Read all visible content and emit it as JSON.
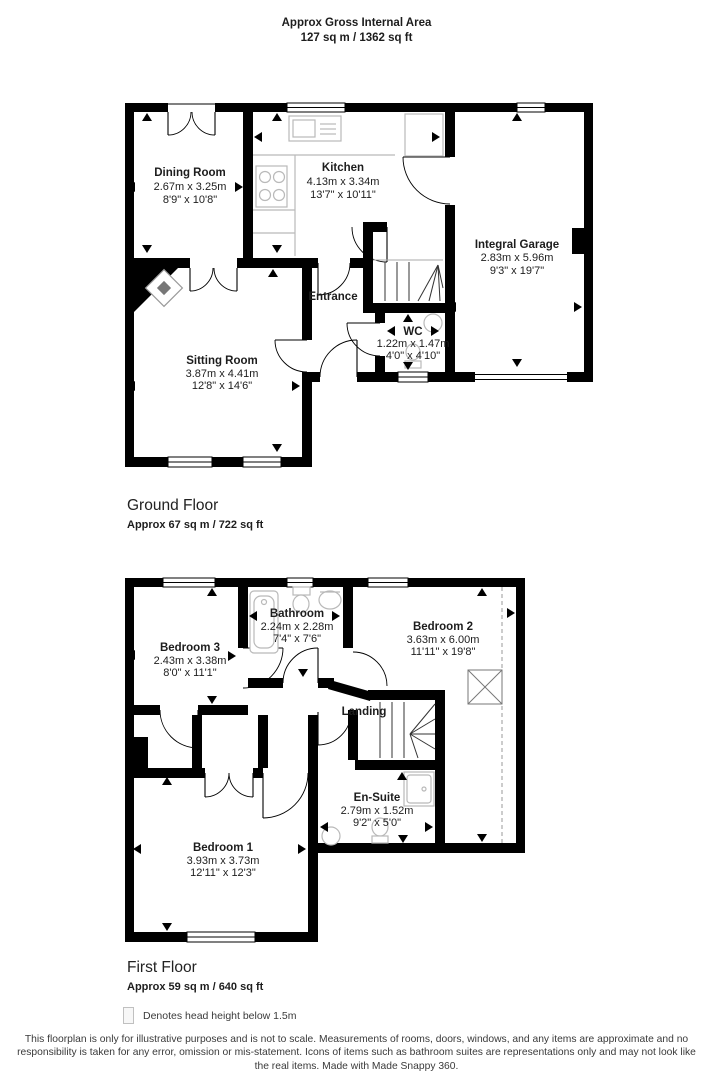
{
  "header": {
    "title": "Approx Gross Internal Area",
    "area": "127 sq m / 1362 sq ft"
  },
  "ground": {
    "title": "Ground Floor",
    "area": "Approx 67 sq m / 722 sq ft",
    "rooms": {
      "dining": {
        "name": "Dining Room",
        "metric": "2.67m x 3.25m",
        "imperial": "8'9\" x 10'8\""
      },
      "kitchen": {
        "name": "Kitchen",
        "metric": "4.13m x 3.34m",
        "imperial": "13'7\" x 10'11\""
      },
      "garage": {
        "name": "Integral Garage",
        "metric": "2.83m x 5.96m",
        "imperial": "9'3\" x 19'7\""
      },
      "entrance": {
        "name": "Entrance"
      },
      "wc": {
        "name": "WC",
        "metric": "1.22m x 1.47m",
        "imperial": "4'0\" x 4'10\""
      },
      "sitting": {
        "name": "Sitting Room",
        "metric": "3.87m x 4.41m",
        "imperial": "12'8\" x 14'6\""
      }
    }
  },
  "first": {
    "title": "First Floor",
    "area": "Approx 59 sq m / 640 sq ft",
    "rooms": {
      "bedroom3": {
        "name": "Bedroom 3",
        "metric": "2.43m x 3.38m",
        "imperial": "8'0\" x 11'1\""
      },
      "bathroom": {
        "name": "Bathroom",
        "metric": "2.24m x 2.28m",
        "imperial": "7'4\" x 7'6\""
      },
      "bedroom2": {
        "name": "Bedroom 2",
        "metric": "3.63m x 6.00m",
        "imperial": "11'11\" x 19'8\""
      },
      "landing": {
        "name": "Landing"
      },
      "ensuite": {
        "name": "En-Suite",
        "metric": "2.79m x 1.52m",
        "imperial": "9'2\" x 5'0\""
      },
      "bedroom1": {
        "name": "Bedroom 1",
        "metric": "3.93m x 3.73m",
        "imperial": "12'11\" x 12'3\""
      }
    }
  },
  "legend": {
    "text": "Denotes head height below 1.5m"
  },
  "disclaimer": "This floorplan is only for illustrative purposes and is not to scale. Measurements of rooms, doors, windows, and any items are approximate and no responsibility is taken for any error, omission or mis-statement. Icons of items such as bathroom suites are representations only and may not look like the real items. Made with Made Snappy 360.",
  "colors": {
    "wall": "#000000",
    "fixture": "#b9b9b9",
    "text": "#1d1d1d"
  }
}
